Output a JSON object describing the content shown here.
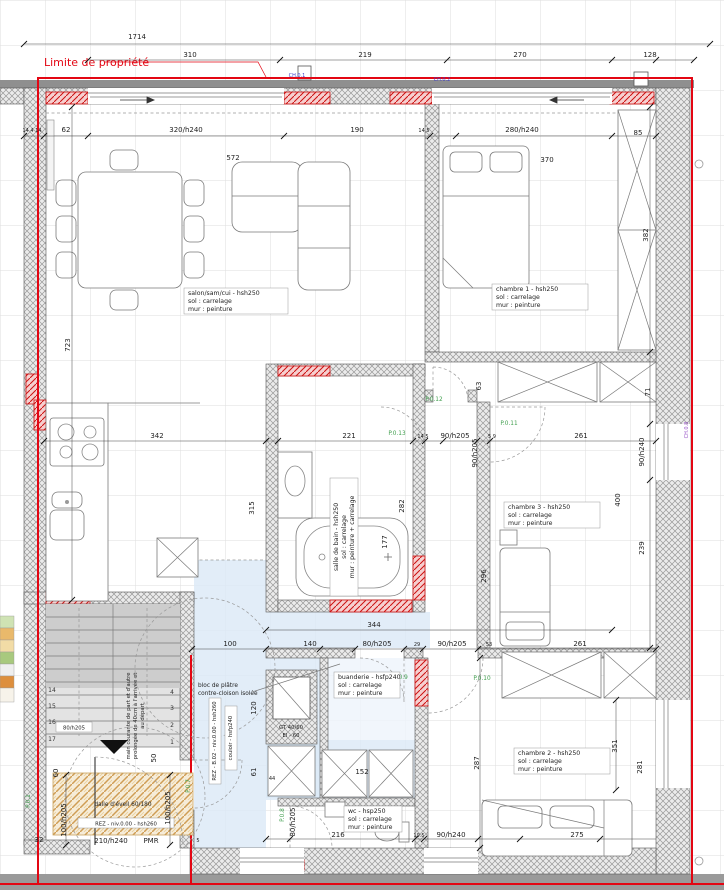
{
  "property": {
    "label": "Limite de propriété"
  },
  "colors": {
    "property_line": "#e30613",
    "hall_fill": "#dbe8f6",
    "dalle_fill": "#f6ecd8",
    "door_label_green": "#3f9e4d",
    "code_blue": "#3c3cc8",
    "code_purple": "#9a55c8",
    "red_hatch": "#cc1111"
  },
  "rooms": {
    "salon": {
      "line1": "salon/sam/cui - hsh250",
      "line2": "sol : carrelage",
      "line3": "mur : peinture"
    },
    "chambre1": {
      "line1": "chambre 1 - hsh250",
      "line2": "sol : carrelage",
      "line3": "mur : peinture"
    },
    "chambre2": {
      "line1": "chambre 2 - hsh250",
      "line2": "sol : carrelage",
      "line3": "mur : peinture"
    },
    "chambre3": {
      "line1": "chambre 3 - hsh250",
      "line2": "sol : carrelage",
      "line3": "mur : peinture"
    },
    "salle_de_bain": {
      "line1": "salle de bain - hsh250",
      "line2": "sol : carrelage",
      "line3": "mur : peinture + carrelage"
    },
    "buanderie": {
      "line1": "buanderie - hsfp240",
      "line2": "sol : carrelage",
      "line3": "mur : peinture"
    },
    "wc": {
      "line1": "wc - hsp250",
      "line2": "sol : carrelage",
      "line3": "mur : peinture"
    },
    "couloir": {
      "box1": "REZ - B.02 - niv.0.00 - hsh260",
      "box2": "couloir - hsfp240"
    },
    "entry": {
      "level_box": "REZ - niv.0.00 - hsh260",
      "door": "210/h240",
      "pmr": "PMR",
      "dalle": "dalle d'éveil 60/180"
    },
    "gt": {
      "line1": "GT 40/60",
      "line2": "EI - 60"
    },
    "partition": {
      "line1": "bloc de plâtre",
      "line2": "contre-cloison isolée"
    },
    "stairs": {
      "note1": "main courante de part et d'autre",
      "note2": "prolongée de 40cm à l'arrivée et",
      "note3": "au départ",
      "door": "80/h205"
    }
  },
  "doors": {
    "p0_1": "P.0.1",
    "p0_7": "P.0.7",
    "p0_8": "P.0.8",
    "p0_9": "P.0.9",
    "p0_10": "P.0.10",
    "p0_11": "P.0.11",
    "p0_12": "P.0.12",
    "p0_13": "P.0.13"
  },
  "codes": {
    "top_left": "CH.0.1",
    "top_right": "CH.0.2",
    "right": "CH.0.8"
  },
  "steps": {
    "s1": "1",
    "s2": "2",
    "s3": "3",
    "s4": "4",
    "s14": "14",
    "s15": "15",
    "s16": "16",
    "s17": "17"
  },
  "dims": {
    "total_top": "1714",
    "top_a": "310",
    "top_b": "219",
    "top_c": "270",
    "top_d": "128",
    "wall_stack": "14 4 14",
    "left_62": "62",
    "win_salon": "320/h240",
    "d190": "190",
    "d145a": "14 5",
    "win_ch1": "280/h240",
    "d572": "572",
    "d370": "370",
    "d85": "85",
    "d723": "723",
    "d382": "382",
    "d71": "71",
    "win_ch3": "90/h240",
    "d400": "400",
    "d239": "239",
    "d342": "342",
    "d221": "221",
    "door_90a": "90/h205",
    "d145b": "14 5",
    "d59": "5 9",
    "door_90b": "90/h205",
    "d261a": "261",
    "d63": "63",
    "d315": "315",
    "d282": "282",
    "d177": "177",
    "d296": "296",
    "d344": "344",
    "d100": "100",
    "d140": "140",
    "door_80a": "80/h205",
    "d29": "29",
    "door_90c": "90/h205",
    "d53": "53",
    "d261b": "261",
    "d120": "120",
    "d61": "61",
    "d44": "44",
    "d152": "152",
    "d216": "216",
    "d195": "19.5",
    "win_wc": "90/h240",
    "d275": "275",
    "door_80b": "80/h205",
    "door_100a": "100/h205",
    "door_100b": "100/h205",
    "d60": "60",
    "d50": "50",
    "d32": "32",
    "d5": "5",
    "d287": "287",
    "d351": "351",
    "d281": "281"
  }
}
